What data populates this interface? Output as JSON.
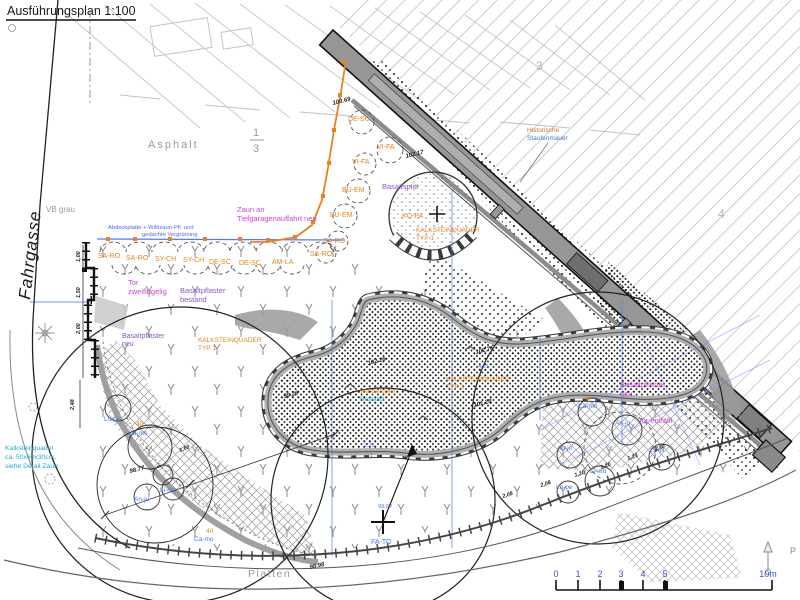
{
  "labels": {
    "title": "Ausführungsplan 1:100",
    "fahrgasse": "Fahrgasse",
    "asphalt": "Asphalt",
    "frac_num": "1",
    "frac_den": "3",
    "vb_grau": "VB grau",
    "zone3": "3",
    "zone4": "4",
    "platten": "Platten",
    "hist1": "Historische",
    "hist2": "Staufenmauer",
    "zaun1": "Zaun an",
    "zaun2": "Tiefgaragenauffahrt neu",
    "blue_note1": "Abdeckplatte + Wildzaun-Pfl. und",
    "blue_note2": "gedachte Vergrünung",
    "tor1": "Tor",
    "tor2": "zweiflügelig",
    "tor_entfaellt": "Tor entfällt",
    "bp_bestand1": "Basaltpflaster",
    "bp_bestand2": "bestand",
    "bp_neu_l1": "Basaltpflaster",
    "bp_neu_l2": "neu",
    "bp_neu_r1": "Basaltpflaster",
    "bp_neu_r2": "neu",
    "basaltsplitt": "Basaltsplitt",
    "ksq": "KALKSTEINQUADER",
    "ksq_typ1": "TYP 1",
    "ksq_typ2": "TYP 2",
    "ksq_note1": "Kalksteinquader",
    "ksq_note2": "ca. 50x60x30cm,",
    "ksq_note3": "siehe Detail Zaun",
    "wasser1": "Wasserspiel",
    "wasser2": "Bestand"
  },
  "plant_codes": {
    "row": [
      "SA-RO",
      "SA-RO",
      "SY-CH",
      "SY-CH",
      "DE-SC",
      "DE-SC",
      "AM-LA"
    ],
    "shrubs": [
      "DE-SC",
      "VI-FA",
      "VI-FA",
      "BU-EM",
      "BU-EM",
      "SA-RO",
      "SA-RO"
    ],
    "tree_kopa": "KO-PA",
    "tree_fato": "FA-TO",
    "left_bed": [
      "Lo-pe",
      "Ca-mo",
      "An-ju",
      "Li-mu",
      "Ca-mo"
    ],
    "right_bed": [
      "Ca-mo",
      "An-ju",
      "An-ju",
      "Lo-pi",
      "Li-mu",
      "Lo-pe"
    ],
    "qty40": "40"
  },
  "elevations": [
    "100.69",
    "102.17",
    "102.26",
    "102.75",
    "101.28",
    "99.26",
    "98.77",
    "98.98"
  ],
  "elevation_blue": "99.04",
  "dimensions": {
    "bottom": [
      "2,08",
      "2,08",
      "1,20",
      "1,20",
      "1,23",
      "1,30"
    ],
    "left": [
      "1,00",
      "1,50",
      "2,00",
      "2,48"
    ],
    "diag": "1,60",
    "blue_a": "4,31",
    "blue_b": "2,15",
    "blue_c": "1"
  },
  "scale_bar": {
    "ticks": [
      "0",
      "1",
      "2",
      "3",
      "4",
      "5"
    ],
    "end": "10m"
  },
  "north_letter": "P",
  "colors": {
    "wall_gray": "#8f8f8f",
    "fence_orange": "#e8821e",
    "grid_blue": "#5577ff",
    "magenta": "#cc44cc",
    "purple": "#8855cc",
    "teal": "#22aacc"
  }
}
